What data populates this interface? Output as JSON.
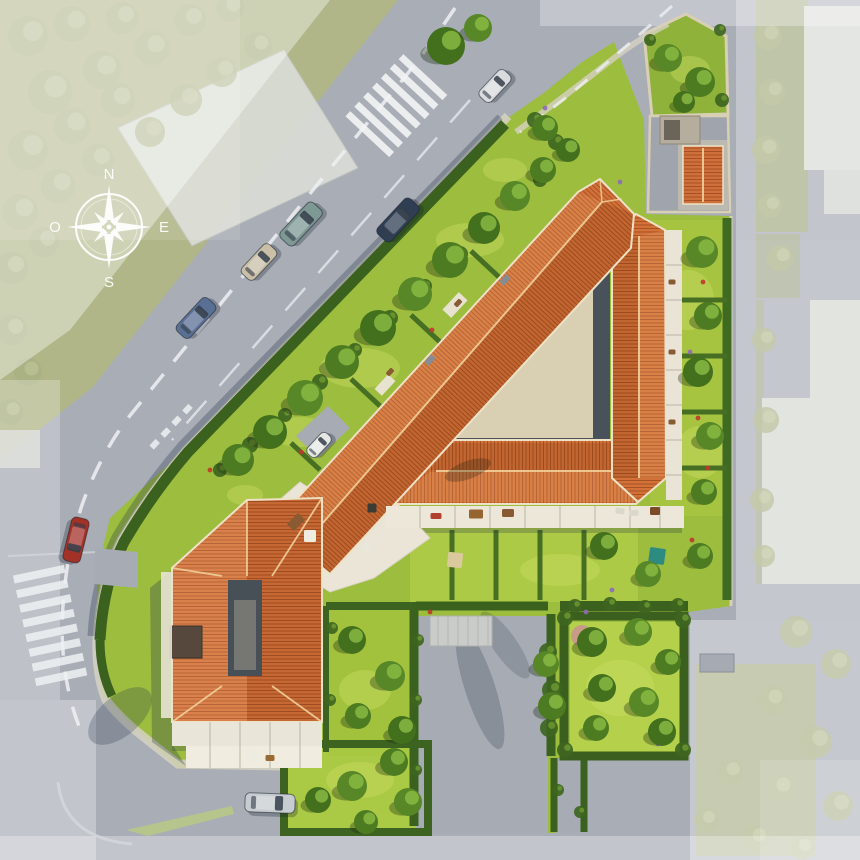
{
  "meta": {
    "description": "Aerial 3D site-plan rendering of a residential development: angular building complex with terracotta tiled roofs around a beige inner courtyard, private gardens, hedges, surrounding streets with parked cars, faded neighbouring blocks, and a white compass rose."
  },
  "compass": {
    "north": "N",
    "east": "E",
    "south": "S",
    "west": "O"
  },
  "palette": {
    "road": "#a8adb6",
    "road_faded": "#c4c7cd",
    "lawn": "#9dbd3e",
    "lawn_light": "#c4da55",
    "tree": "#4d7b22",
    "hedge": "#3b611e",
    "roof_tile": "#d27238",
    "roof_shade": "#c96a36",
    "courtyard": "#d9cfb3",
    "terrace": "#ece7d9",
    "neighbor_building": "#d9dbd5",
    "marking": "#eef0f2",
    "shadow": "rgba(38,54,74,0.30)",
    "compass": "#ffffff"
  },
  "vegetation": {
    "site_trees": [
      [
        238,
        460,
        16
      ],
      [
        270,
        432,
        17
      ],
      [
        305,
        398,
        18
      ],
      [
        342,
        362,
        17
      ],
      [
        378,
        328,
        18
      ],
      [
        415,
        294,
        17
      ],
      [
        450,
        260,
        18
      ],
      [
        484,
        228,
        16
      ],
      [
        515,
        196,
        15
      ],
      [
        543,
        170,
        13
      ],
      [
        446,
        46,
        19
      ],
      [
        478,
        28,
        14
      ],
      [
        545,
        128,
        13
      ],
      [
        568,
        150,
        12
      ],
      [
        668,
        58,
        14
      ],
      [
        700,
        82,
        15
      ],
      [
        684,
        102,
        11
      ],
      [
        702,
        252,
        16
      ],
      [
        708,
        316,
        14
      ],
      [
        698,
        372,
        15
      ],
      [
        710,
        436,
        14
      ],
      [
        704,
        492,
        13
      ],
      [
        604,
        546,
        14
      ],
      [
        648,
        574,
        13
      ],
      [
        700,
        556,
        13
      ],
      [
        592,
        642,
        15
      ],
      [
        638,
        632,
        14
      ],
      [
        668,
        662,
        13
      ],
      [
        602,
        688,
        14
      ],
      [
        644,
        702,
        15
      ],
      [
        596,
        728,
        13
      ],
      [
        662,
        732,
        14
      ],
      [
        352,
        786,
        15
      ],
      [
        394,
        762,
        14
      ],
      [
        318,
        800,
        13
      ],
      [
        408,
        802,
        14
      ],
      [
        366,
        822,
        12
      ],
      [
        352,
        640,
        14
      ],
      [
        390,
        676,
        15
      ],
      [
        358,
        716,
        13
      ],
      [
        402,
        730,
        14
      ],
      [
        546,
        664,
        13
      ],
      [
        552,
        706,
        14
      ]
    ],
    "faded_trees": [
      [
        28,
        36,
        20
      ],
      [
        72,
        24,
        18
      ],
      [
        122,
        18,
        16
      ],
      [
        50,
        92,
        22
      ],
      [
        102,
        70,
        19
      ],
      [
        152,
        48,
        17
      ],
      [
        28,
        150,
        20
      ],
      [
        72,
        126,
        18
      ],
      [
        118,
        100,
        17
      ],
      [
        20,
        212,
        18
      ],
      [
        58,
        186,
        17
      ],
      [
        98,
        160,
        16
      ],
      [
        150,
        132,
        15
      ],
      [
        186,
        100,
        16
      ],
      [
        222,
        72,
        15
      ],
      [
        258,
        46,
        14
      ],
      [
        190,
        20,
        16
      ],
      [
        230,
        8,
        14
      ],
      [
        12,
        268,
        16
      ],
      [
        44,
        242,
        15
      ],
      [
        12,
        330,
        15
      ],
      [
        28,
        372,
        14
      ],
      [
        10,
        412,
        13
      ],
      [
        768,
        36,
        14
      ],
      [
        772,
        92,
        13
      ],
      [
        766,
        150,
        14
      ],
      [
        770,
        206,
        12
      ],
      [
        780,
        258,
        13
      ],
      [
        764,
        340,
        12
      ],
      [
        766,
        420,
        13
      ],
      [
        762,
        500,
        12
      ],
      [
        764,
        556,
        11
      ],
      [
        796,
        632,
        16
      ],
      [
        836,
        664,
        15
      ],
      [
        772,
        700,
        14
      ],
      [
        816,
        742,
        16
      ],
      [
        780,
        788,
        14
      ],
      [
        838,
        806,
        15
      ],
      [
        756,
        838,
        13
      ],
      [
        802,
        848,
        12
      ],
      [
        730,
        772,
        13
      ],
      [
        706,
        820,
        12
      ]
    ],
    "bushes": [
      [
        220,
        470,
        7
      ],
      [
        250,
        445,
        8
      ],
      [
        285,
        415,
        7
      ],
      [
        320,
        382,
        8
      ],
      [
        355,
        350,
        7
      ],
      [
        390,
        318,
        8
      ],
      [
        425,
        286,
        7
      ],
      [
        460,
        254,
        8
      ],
      [
        492,
        225,
        7
      ],
      [
        520,
        198,
        7
      ],
      [
        672,
        258,
        5
      ],
      [
        672,
        294,
        5
      ],
      [
        672,
        330,
        5
      ],
      [
        672,
        366,
        5
      ],
      [
        672,
        402,
        5
      ],
      [
        672,
        438,
        5
      ],
      [
        548,
        652,
        9
      ],
      [
        552,
        690,
        10
      ],
      [
        549,
        728,
        9
      ],
      [
        575,
        606,
        7
      ],
      [
        610,
        604,
        7
      ],
      [
        645,
        607,
        7
      ],
      [
        678,
        605,
        7
      ],
      [
        565,
        618,
        8
      ],
      [
        683,
        620,
        8
      ],
      [
        565,
        750,
        8
      ],
      [
        683,
        750,
        8
      ],
      [
        650,
        40,
        6
      ],
      [
        720,
        30,
        6
      ],
      [
        722,
        100,
        7
      ],
      [
        535,
        120,
        8
      ],
      [
        556,
        142,
        8
      ],
      [
        540,
        180,
        7
      ],
      [
        198,
        750,
        5
      ],
      [
        310,
        748,
        5
      ],
      [
        332,
        628,
        6
      ],
      [
        330,
        700,
        6
      ],
      [
        418,
        640,
        6
      ],
      [
        416,
        700,
        6
      ],
      [
        416,
        770,
        6
      ],
      [
        558,
        790,
        6
      ],
      [
        580,
        812,
        6
      ]
    ],
    "lawn_patches": [
      [
        360,
        368,
        40,
        20
      ],
      [
        300,
        432,
        30,
        15
      ],
      [
        470,
        240,
        34,
        17
      ],
      [
        688,
        300,
        26,
        30
      ],
      [
        700,
        452,
        24,
        26
      ],
      [
        560,
        570,
        40,
        16
      ],
      [
        620,
        688,
        34,
        28
      ],
      [
        360,
        780,
        34,
        18
      ],
      [
        365,
        690,
        26,
        20
      ],
      [
        690,
        70,
        20,
        14
      ],
      [
        505,
        170,
        22,
        12
      ],
      [
        245,
        495,
        18,
        10
      ]
    ],
    "flowers": [
      [
        432,
        330,
        "#c0392b"
      ],
      [
        523,
        296,
        "#c0392b"
      ],
      [
        301,
        452,
        "#c0392b"
      ],
      [
        703,
        282,
        "#c0392b"
      ],
      [
        708,
        468,
        "#c0392b"
      ],
      [
        352,
        642,
        "#c0392b"
      ],
      [
        260,
        436,
        "#c0392b"
      ],
      [
        692,
        540,
        "#c0392b"
      ],
      [
        210,
        470,
        "#c0392b"
      ],
      [
        698,
        418,
        "#c0392b"
      ],
      [
        430,
        612,
        "#c0392b"
      ],
      [
        690,
        352,
        "#8e6bb5"
      ],
      [
        612,
        590,
        "#8e6bb5"
      ],
      [
        658,
        744,
        "#8e6bb5"
      ],
      [
        586,
        612,
        "#8e6bb5"
      ],
      [
        620,
        182,
        "#8e6bb5"
      ],
      [
        545,
        108,
        "#8e6bb5"
      ],
      [
        700,
        94,
        "#8e6bb5"
      ]
    ]
  },
  "vehicles": {
    "parked": [
      {
        "label": "van",
        "x": 495,
        "y": 86,
        "angle": -47,
        "color": "#d9dbde",
        "len": 36,
        "wid": 16
      },
      {
        "label": "sedan-dark",
        "x": 398,
        "y": 220,
        "angle": -47,
        "color": "#2f3e53",
        "len": 48,
        "wid": 19
      },
      {
        "label": "minivan-teal",
        "x": 301,
        "y": 224,
        "angle": -47,
        "color": "#7e9894",
        "len": 48,
        "wid": 19
      },
      {
        "label": "hatchback-beige",
        "x": 259,
        "y": 262,
        "angle": -47,
        "color": "#cabfa7",
        "len": 40,
        "wid": 17
      },
      {
        "label": "sedan-blue",
        "x": 196,
        "y": 318,
        "angle": -47,
        "color": "#5a6f94",
        "len": 45,
        "wid": 18
      },
      {
        "label": "sedan-red",
        "x": 76,
        "y": 540,
        "angle": 104,
        "color": "#a23128",
        "len": 45,
        "wid": 18
      },
      {
        "label": "estate-silver",
        "x": 270,
        "y": 803,
        "angle": 2,
        "color": "#c7ccd1",
        "len": 50,
        "wid": 19
      },
      {
        "label": "delivery-van",
        "x": 319,
        "y": 445,
        "angle": -47,
        "color": "#e6e8e4",
        "len": 28,
        "wid": 13
      }
    ]
  },
  "terrace_furniture": [
    [
      296,
      522,
      16,
      10,
      "#8a5a32",
      -45
    ],
    [
      310,
      536,
      12,
      12,
      "#efece2",
      0
    ],
    [
      372,
      508,
      9,
      9,
      "#3c3c36",
      0
    ],
    [
      436,
      516,
      11,
      6,
      "#b2402e",
      0
    ],
    [
      476,
      514,
      14,
      9,
      "#96642f",
      0
    ],
    [
      508,
      513,
      12,
      8,
      "#8a5a32",
      0
    ],
    [
      620,
      511,
      9,
      6,
      "#dad7cb",
      8
    ],
    [
      634,
      513,
      9,
      6,
      "#dad7cb",
      -6
    ],
    [
      655,
      511,
      10,
      8,
      "#7c4b28",
      0
    ],
    [
      455,
      560,
      15,
      15,
      "#d9c99c",
      6
    ],
    [
      657,
      556,
      16,
      16,
      "#2e8b80",
      8
    ],
    [
      367,
      546,
      11,
      8,
      "#e9e6dc",
      -42
    ],
    [
      253,
      756,
      12,
      12,
      "#eeebe1",
      0
    ],
    [
      270,
      758,
      9,
      6,
      "#9a6a34",
      0
    ],
    [
      458,
      303,
      8,
      5,
      "#8a5a32",
      -47
    ],
    [
      390,
      372,
      8,
      5,
      "#8a5a32",
      -47
    ],
    [
      672,
      282,
      7,
      5,
      "#8a5a32",
      0
    ],
    [
      672,
      352,
      7,
      5,
      "#8a5a32",
      0
    ],
    [
      672,
      422,
      7,
      5,
      "#8a5a32",
      0
    ]
  ]
}
